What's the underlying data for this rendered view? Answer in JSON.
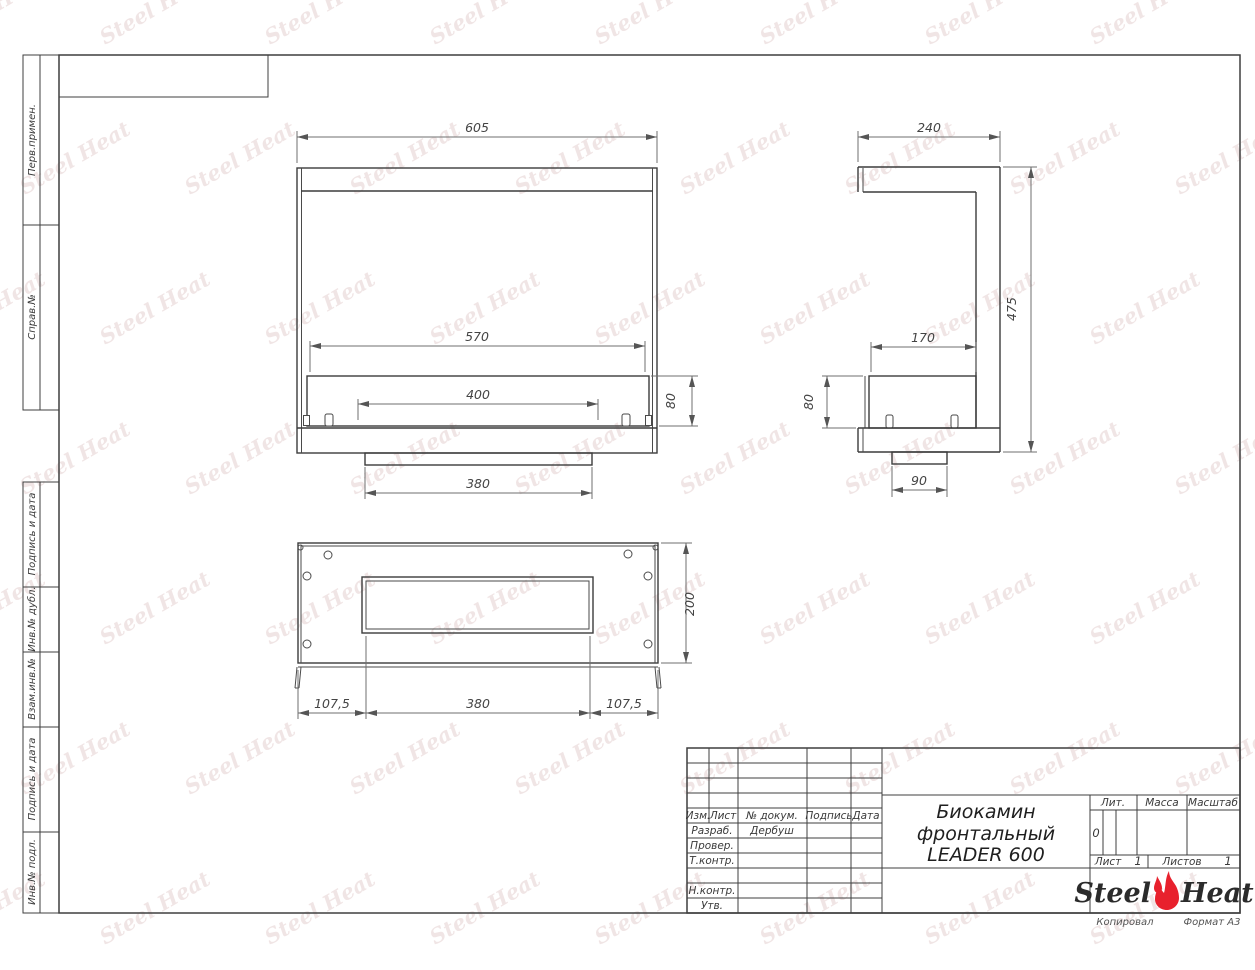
{
  "sheet": {
    "copied_label": "Копировал",
    "format_label": "Формат А3"
  },
  "watermark": {
    "text": "Steel Heat"
  },
  "margin_boxes": [
    {
      "label": "Перв.примен."
    },
    {
      "label": "Справ.№"
    },
    {
      "label": "Подпись и дата"
    },
    {
      "label": "Инв.№ дубл."
    },
    {
      "label": "Взам.инв.№"
    },
    {
      "label": "Подпись и дата"
    },
    {
      "label": "Инв.№ подл."
    }
  ],
  "title_block": {
    "header_cols": [
      "Изм.",
      "Лист",
      "№ докум.",
      "Подпись",
      "Дата"
    ],
    "sign_rows": [
      {
        "label": "Разраб.",
        "name": "Дербуш"
      },
      {
        "label": "Провер.",
        "name": ""
      },
      {
        "label": "Т.контр.",
        "name": ""
      },
      {
        "label": "Н.контр.",
        "name": ""
      },
      {
        "label": "Утв.",
        "name": ""
      }
    ],
    "doc_title_line1": "Биокамин",
    "doc_title_line2": "фронтальный",
    "doc_title_line3": "LEADER 600",
    "lit_label": "Лит.",
    "lit_value": "0",
    "mass_label": "Масса",
    "scale_label": "Масштаб",
    "sheet_label": "Лист",
    "sheet_value": "1",
    "sheets_label": "Листов",
    "sheets_value": "1",
    "logo_left": "Steel",
    "logo_right": "Heat",
    "logo_flame_color": "#e8212d"
  },
  "dims": {
    "front": {
      "width": "605",
      "inner_width": "570",
      "burner": "400",
      "base": "380",
      "tray_height": "80"
    },
    "side": {
      "depth": "240",
      "height": "475",
      "tray_depth": "170",
      "tray_height": "80",
      "base": "90"
    },
    "plan": {
      "depth": "200",
      "offset_left": "107,5",
      "opening": "380",
      "offset_right": "107,5"
    }
  }
}
